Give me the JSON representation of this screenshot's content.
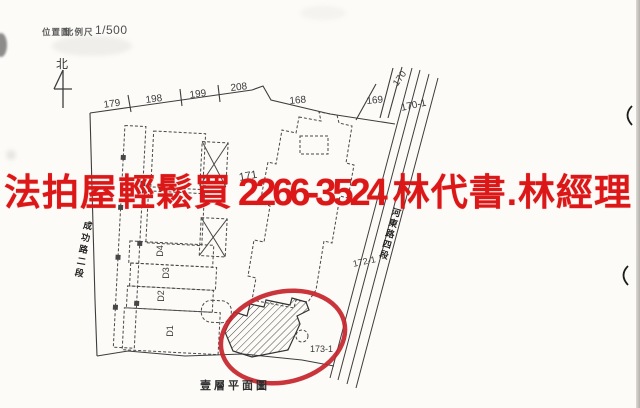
{
  "header": {
    "title": "位置圖",
    "scale_label": "比例尺",
    "scale_value": "1/500"
  },
  "compass": {
    "north_label": "北"
  },
  "ad_overlay": {
    "prefix": "法拍屋輕鬆買",
    "phone": "2266-3524",
    "suffix": "林代書.林經理",
    "color": "#dc1717"
  },
  "streets": {
    "left": "成功路二段",
    "right": "河東路四段"
  },
  "parcels": {
    "p179": "179",
    "p198": "198",
    "p199": "199",
    "p208": "208",
    "p168": "168",
    "p169": "169",
    "p170": "170",
    "p170_1": "170-1",
    "p171": "171",
    "p172_1": "172-1",
    "p173_1": "173-1"
  },
  "units": {
    "d1": "D1",
    "d2": "D2",
    "d3": "D3",
    "d4": "D4"
  },
  "caption": {
    "text": "壹層平面圖"
  },
  "colors": {
    "ad_red": "#dc1717",
    "highlight_red": "#c5242b",
    "linework": "#3d3d3d",
    "paper": "#fcfbf8"
  }
}
